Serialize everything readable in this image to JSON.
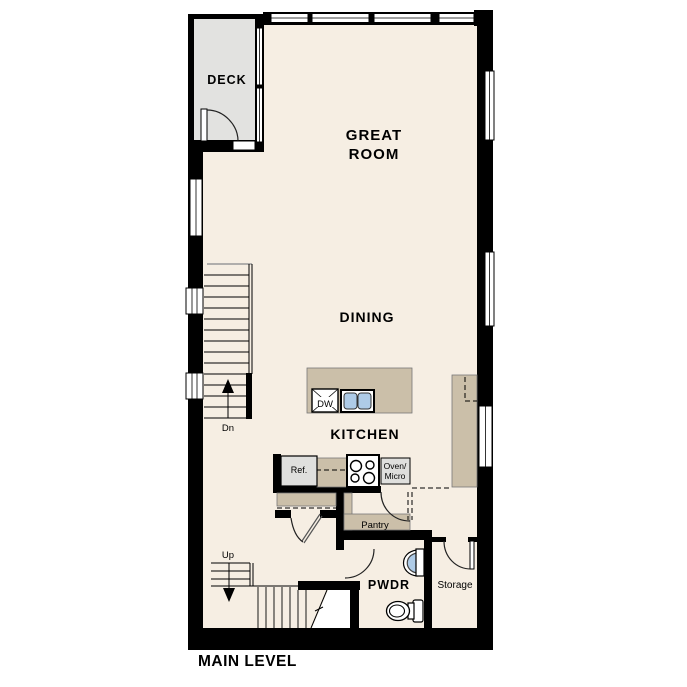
{
  "plan_title": "MAIN LEVEL",
  "labels": {
    "deck": "DECK",
    "great_room_line1": "GREAT",
    "great_room_line2": "ROOM",
    "dining": "DINING",
    "kitchen": "KITCHEN",
    "pantry": "Pantry",
    "pwdr": "PWDR",
    "storage": "Storage"
  },
  "fixtures": {
    "dishwasher": "DW",
    "refrigerator": "Ref.",
    "oven_line1": "Oven/",
    "oven_line2": "Micro"
  },
  "stairs": {
    "down_label": "Dn",
    "up_label": "Up"
  },
  "colors": {
    "wall": "#000000",
    "floor": "#F6EEE3",
    "deck_floor": "#E2E2E0",
    "counter": "#CBBFA9",
    "appliance_fill": "#DFDFDD",
    "sink_blue": "#AECBE7",
    "background": "#FFFFFF",
    "label_text": "#000000"
  }
}
